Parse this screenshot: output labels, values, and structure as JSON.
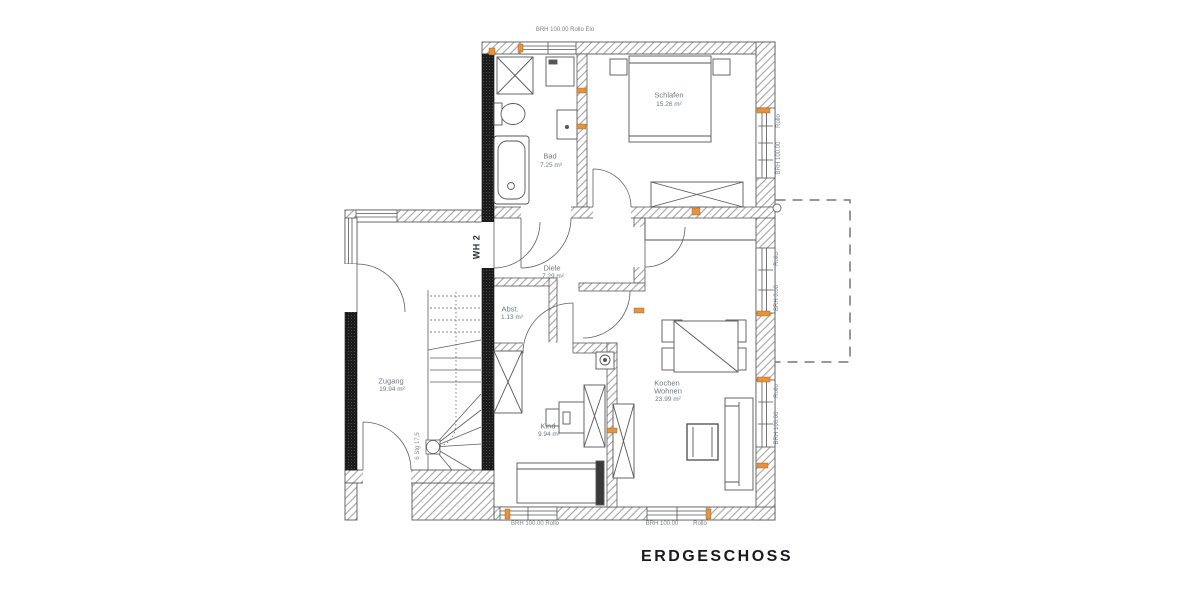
{
  "title": "ERDGESCHOSS",
  "unit_label": "WH 2",
  "rooms": {
    "schlafen": {
      "name": "Schlafen",
      "area": "15.26 m²"
    },
    "bad": {
      "name": "Bad",
      "area": "7.25 m²"
    },
    "diele": {
      "name": "Diele",
      "area": "7.29 m²"
    },
    "abst": {
      "name": "Abst.",
      "area": "1.13 m²"
    },
    "zugang": {
      "name": "Zugang",
      "area": "19.94 m²"
    },
    "kind": {
      "name": "Kind",
      "area": "9.94 m²"
    },
    "kochen_wohnen": {
      "name": "Kochen",
      "name2": "Wohnen",
      "area": "23.99 m²"
    }
  },
  "windows": {
    "top": "BRH 100.00  Rollo Elo",
    "right_schlafen": {
      "line1": "Rollo",
      "line2": "BRH 100.00"
    },
    "right_terrasse": {
      "line1": "Rollo",
      "line2": "BRH 0.00"
    },
    "right_wohnen": {
      "line1": "Rollo",
      "line2": "BRH 100.00"
    },
    "bottom_kind": "BRH 100.00  Rollo",
    "bottom_wohnen_1": "BRH 100.00",
    "bottom_wohnen_2": "Rollo"
  },
  "stairs": {
    "label": "6 Stg 17,5"
  },
  "colors": {
    "marker": "#e8923a",
    "text": "#6e7886",
    "title": "#191922",
    "wall_dark": "#1e1e1e"
  }
}
